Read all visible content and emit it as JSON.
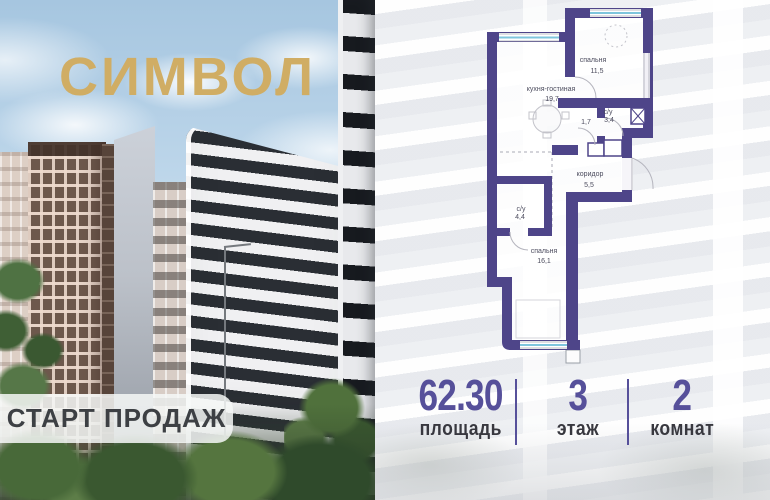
{
  "brand": {
    "name": "СИМВОЛ",
    "color": "#d0ad64"
  },
  "badge": {
    "label": "СТАРТ ПРОДАЖ"
  },
  "floor_plan": {
    "wall_color": "#4e4589",
    "window_color": "#7fc6dd",
    "rooms": [
      {
        "name": "спальня",
        "area": "11,5"
      },
      {
        "name": "кухня-гостиная",
        "area": "19,7"
      },
      {
        "name": "с/у",
        "area": "3,4"
      },
      {
        "name": "",
        "area": "1,7"
      },
      {
        "name": "коридор",
        "area": "5,5"
      },
      {
        "name": "с/у",
        "area": "4,4"
      },
      {
        "name": "спальня",
        "area": "16,1"
      }
    ]
  },
  "stats": {
    "accent_color": "#56509a",
    "items": [
      {
        "value": "62.30",
        "label": "площадь"
      },
      {
        "value": "3",
        "label": "этаж"
      },
      {
        "value": "2",
        "label": "комнат"
      }
    ]
  }
}
